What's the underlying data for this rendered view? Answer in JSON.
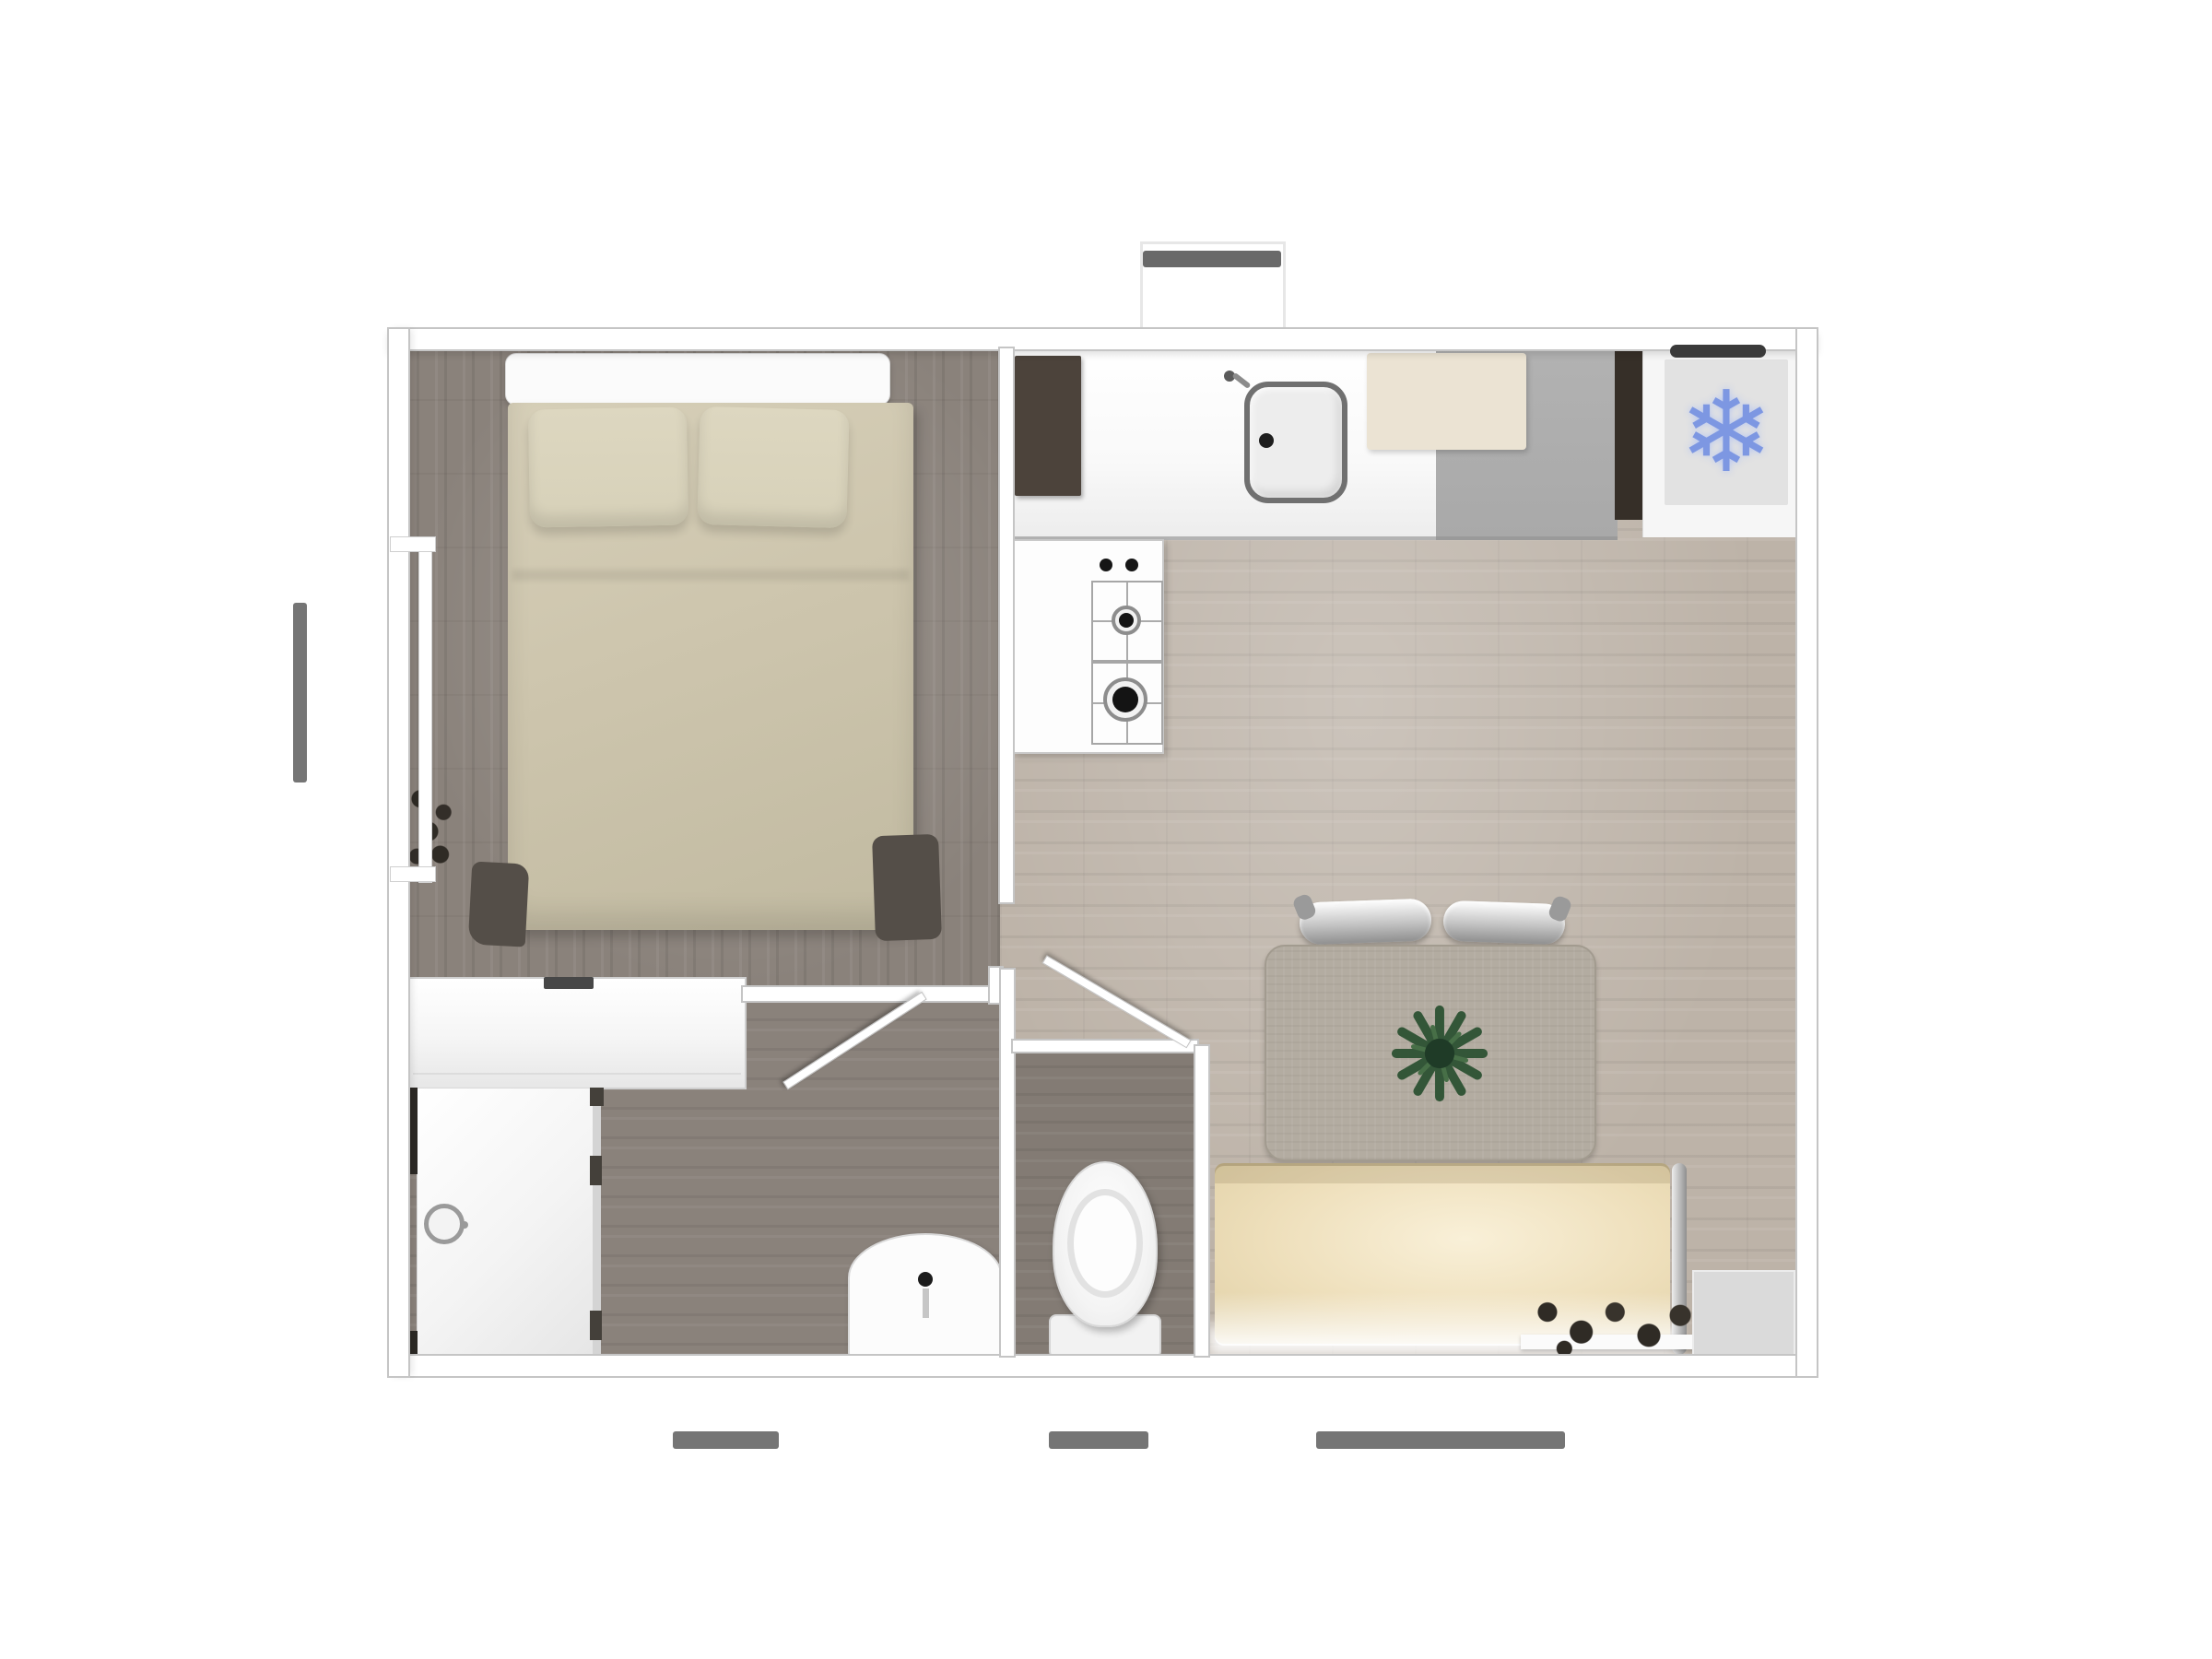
{
  "plan": {
    "rooms": [
      "bedroom",
      "kitchen-living-room",
      "hallway",
      "bathroom",
      "wc"
    ],
    "features": [
      "left-window",
      "top-vent-marker",
      "bottom-window-markers",
      "bathroom-door",
      "wc-door",
      "shower-glass-door"
    ],
    "furniture": [
      "double-bed",
      "pillows",
      "wardrobe",
      "window-plant",
      "kitchen-counter",
      "kitchen-sink",
      "cutting-board",
      "tall-dark-cabinet",
      "gas-hob",
      "refrigerator",
      "rug",
      "plant-centerpiece",
      "curved-silver-cushions",
      "sofa",
      "floor-lamp",
      "decor-shelf",
      "corner-mat",
      "shower",
      "washbasin",
      "toilet"
    ]
  },
  "icons": {
    "snowflake": "❄"
  },
  "colors": {
    "wall": "#ffffff",
    "wall_line": "#c5c5c5",
    "floor_dark": "#8a827b",
    "floor_light": "#bdb3a8",
    "floor_wc": "#837b74",
    "marker_gray": "#757575",
    "bed_headboard": "#fbfbfb",
    "bed_duvet": "#cdc5ad",
    "bed_pillow": "#d7d1b9",
    "bed_frame": "#544e48",
    "closet_body": "#f5f5f5",
    "closet_handle": "#474747",
    "cabinet_dark": "#4c433b",
    "counter_white": "#f9f9f9",
    "counter_gray": "#a9a9a9",
    "counter_strip": "#362f28",
    "board_cream": "#ebe3d3",
    "sink_rim": "#707070",
    "fridge_panel": "#f6f6f6",
    "fridge_inner": "#e2e2e2",
    "fridge_handle": "#3a3a3a",
    "snowflake_blue": "#7d97e2",
    "stove_white": "#fdfdfd",
    "burner_black": "#141414",
    "rug": "#b3aca1",
    "plant_green": "#2d5233",
    "silver": "#c4c4c4",
    "sofa_body": "#eedfbb",
    "sofa_glow": "#f9f0d8",
    "lamp_chrome": "#b5b5b5",
    "decor_dark": "#2f2b25",
    "shower_glass": "#d4d4d4",
    "shower_dark": "#2c2925",
    "porcelain": "#fcfcfc"
  }
}
